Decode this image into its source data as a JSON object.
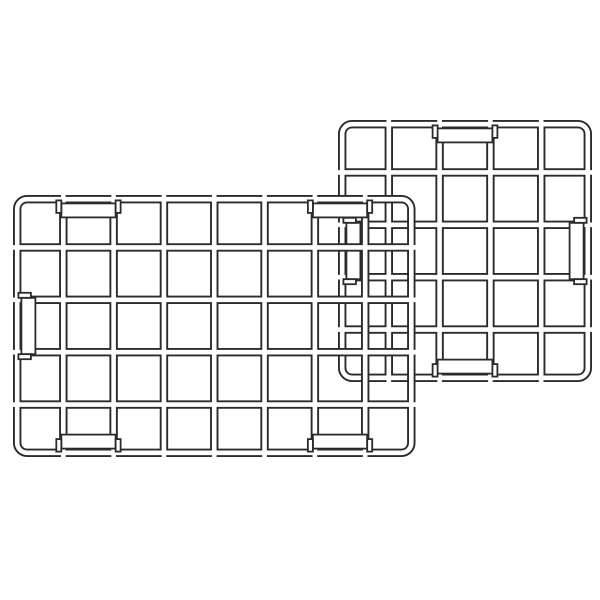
{
  "illustration": {
    "description": "line drawing of two overlapping wire grid panels",
    "canvas": {
      "width": 600,
      "height": 600,
      "background": "#ffffff"
    },
    "style": {
      "wire_color": "#2b2b2b",
      "wire_fill": "#ffffff",
      "wire_width": 8.4,
      "wire_core_width": 4.6,
      "clip_outline_width": 1.8,
      "clip_depth": 14,
      "clip_span_overhang": 2,
      "tab_length": 12.5,
      "tab_thickness": 5,
      "tab_shift": 3
    },
    "panels": [
      {
        "id": "back-grid-panel",
        "x": 338,
        "y": 120,
        "width": 254,
        "height": 262,
        "corner_radius": 14,
        "columns": 5,
        "rows": 5,
        "clips": [
          {
            "edge": "top",
            "cell": 3
          },
          {
            "edge": "bottom",
            "cell": 3
          },
          {
            "edge": "left",
            "cell": 3
          },
          {
            "edge": "right",
            "cell": 3
          }
        ]
      },
      {
        "id": "front-grid-panel",
        "x": 13,
        "y": 195,
        "width": 402.5,
        "height": 262,
        "corner_radius": 14,
        "columns": 8,
        "rows": 5,
        "clips": [
          {
            "edge": "top",
            "cell": 2
          },
          {
            "edge": "top",
            "cell": 7
          },
          {
            "edge": "bottom",
            "cell": 2
          },
          {
            "edge": "bottom",
            "cell": 7
          },
          {
            "edge": "left",
            "cell": 3
          }
        ]
      }
    ]
  }
}
